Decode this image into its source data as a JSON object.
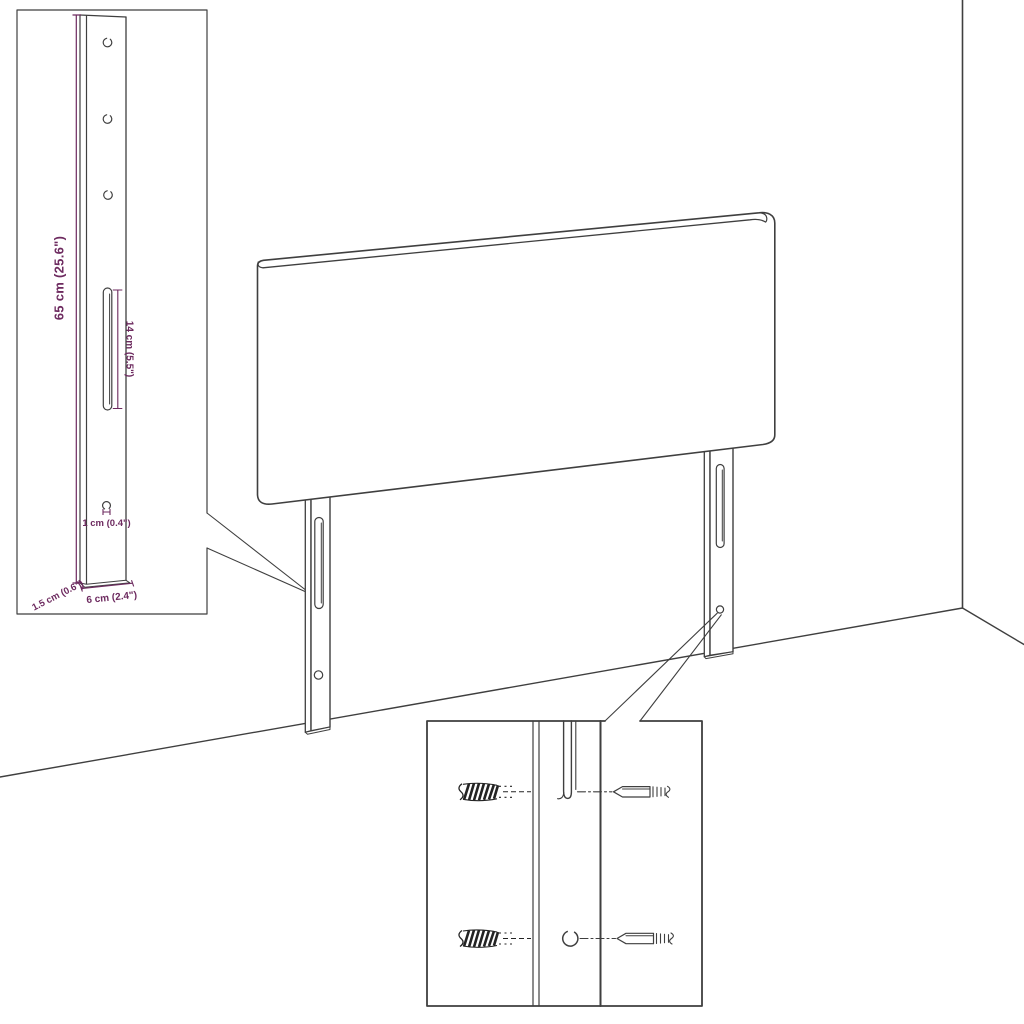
{
  "diagram": {
    "title": "headboard-assembly-dimension-diagram",
    "background": "#ffffff",
    "line_color": "#3f3f3f",
    "dimension_color": "#6d2a5f"
  },
  "bracket_inset": {
    "height_label": "65 cm (25.6\")",
    "slot_label": "14 cm (5.5\")",
    "hole_label": "1 cm (0.4\")",
    "thickness_label": "1.5 cm (0.6\")",
    "width_label": "6 cm (2.4\")"
  }
}
